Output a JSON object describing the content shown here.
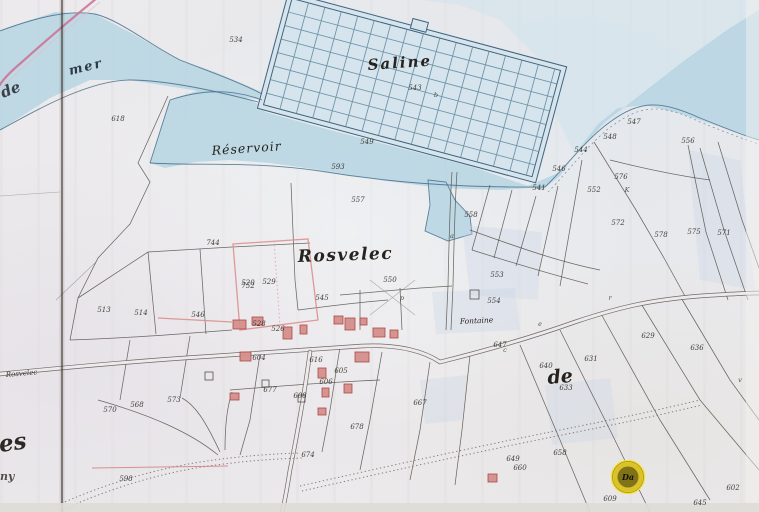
{
  "map": {
    "labels": {
      "saline": "Saline",
      "reservoir": "Réservoir",
      "rosvelec": "Rosvelec",
      "mer": "mer",
      "de_left": "de",
      "de_right": "de",
      "fontaine": "Fontaine",
      "road_name": "Rosvelec",
      "es": "es",
      "ny": "ny"
    },
    "marker": {
      "label": "Da"
    },
    "colors": {
      "water": "#b7d5e2",
      "water_edge": "#46708c",
      "paper": "#eceaec",
      "parcel_line": "#4f4a43",
      "building_red": "#d4908e",
      "boundary_pink": "#cf6f93",
      "marker_gold": "#d9c22a"
    },
    "parcel_numbers": [
      {
        "t": "534",
        "x": 236,
        "y": 42
      },
      {
        "t": "543",
        "x": 415,
        "y": 90
      },
      {
        "t": "549",
        "x": 367,
        "y": 144
      },
      {
        "t": "593",
        "x": 338,
        "y": 169
      },
      {
        "t": "557",
        "x": 358,
        "y": 202
      },
      {
        "t": "618",
        "x": 118,
        "y": 121
      },
      {
        "t": "547",
        "x": 634,
        "y": 124
      },
      {
        "t": "548",
        "x": 610,
        "y": 139
      },
      {
        "t": "556",
        "x": 688,
        "y": 143
      },
      {
        "t": "544",
        "x": 581,
        "y": 152
      },
      {
        "t": "546",
        "x": 559,
        "y": 171
      },
      {
        "t": "541",
        "x": 539,
        "y": 190
      },
      {
        "t": "576",
        "x": 621,
        "y": 179
      },
      {
        "t": "552",
        "x": 594,
        "y": 192
      },
      {
        "t": "572",
        "x": 618,
        "y": 225
      },
      {
        "t": "575",
        "x": 694,
        "y": 234
      },
      {
        "t": "578",
        "x": 661,
        "y": 237
      },
      {
        "t": "571",
        "x": 724,
        "y": 235
      },
      {
        "t": "558",
        "x": 471,
        "y": 217
      },
      {
        "t": "550",
        "x": 390,
        "y": 282
      },
      {
        "t": "553",
        "x": 497,
        "y": 277
      },
      {
        "t": "554",
        "x": 494,
        "y": 303
      },
      {
        "t": "744",
        "x": 213,
        "y": 245
      },
      {
        "t": "752",
        "x": 248,
        "y": 288
      },
      {
        "t": "513",
        "x": 104,
        "y": 312
      },
      {
        "t": "514",
        "x": 141,
        "y": 315
      },
      {
        "t": "546",
        "x": 198,
        "y": 317
      },
      {
        "t": "520",
        "x": 248,
        "y": 285
      },
      {
        "t": "529",
        "x": 269,
        "y": 284
      },
      {
        "t": "545",
        "x": 322,
        "y": 300
      },
      {
        "t": "528",
        "x": 259,
        "y": 326
      },
      {
        "t": "526",
        "x": 278,
        "y": 331
      },
      {
        "t": "604",
        "x": 259,
        "y": 360
      },
      {
        "t": "616",
        "x": 316,
        "y": 362
      },
      {
        "t": "605",
        "x": 341,
        "y": 373
      },
      {
        "t": "606",
        "x": 326,
        "y": 384
      },
      {
        "t": "608",
        "x": 300,
        "y": 398
      },
      {
        "t": "570",
        "x": 110,
        "y": 412
      },
      {
        "t": "568",
        "x": 137,
        "y": 407
      },
      {
        "t": "573",
        "x": 174,
        "y": 402
      },
      {
        "t": "598",
        "x": 126,
        "y": 481
      },
      {
        "t": "677",
        "x": 270,
        "y": 392
      },
      {
        "t": "678",
        "x": 357,
        "y": 429
      },
      {
        "t": "674",
        "x": 308,
        "y": 457
      },
      {
        "t": "667",
        "x": 420,
        "y": 405
      },
      {
        "t": "647",
        "x": 500,
        "y": 347
      },
      {
        "t": "631",
        "x": 591,
        "y": 361
      },
      {
        "t": "636",
        "x": 697,
        "y": 350
      },
      {
        "t": "640",
        "x": 546,
        "y": 368
      },
      {
        "t": "633",
        "x": 566,
        "y": 390
      },
      {
        "t": "658",
        "x": 560,
        "y": 455
      },
      {
        "t": "660",
        "x": 520,
        "y": 470
      },
      {
        "t": "629",
        "x": 648,
        "y": 338
      },
      {
        "t": "649",
        "x": 513,
        "y": 461
      },
      {
        "t": "609",
        "x": 610,
        "y": 501
      },
      {
        "t": "645",
        "x": 700,
        "y": 505
      },
      {
        "t": "602",
        "x": 733,
        "y": 490
      }
    ],
    "section_letters": [
      {
        "t": "K",
        "x": 627,
        "y": 192
      },
      {
        "t": "a",
        "x": 452,
        "y": 238
      },
      {
        "t": "c",
        "x": 505,
        "y": 352
      },
      {
        "t": "e",
        "x": 540,
        "y": 326
      },
      {
        "t": "p",
        "x": 402,
        "y": 300
      },
      {
        "t": "b",
        "x": 436,
        "y": 97
      },
      {
        "t": "v",
        "x": 740,
        "y": 382
      },
      {
        "t": "r",
        "x": 610,
        "y": 300
      }
    ]
  }
}
